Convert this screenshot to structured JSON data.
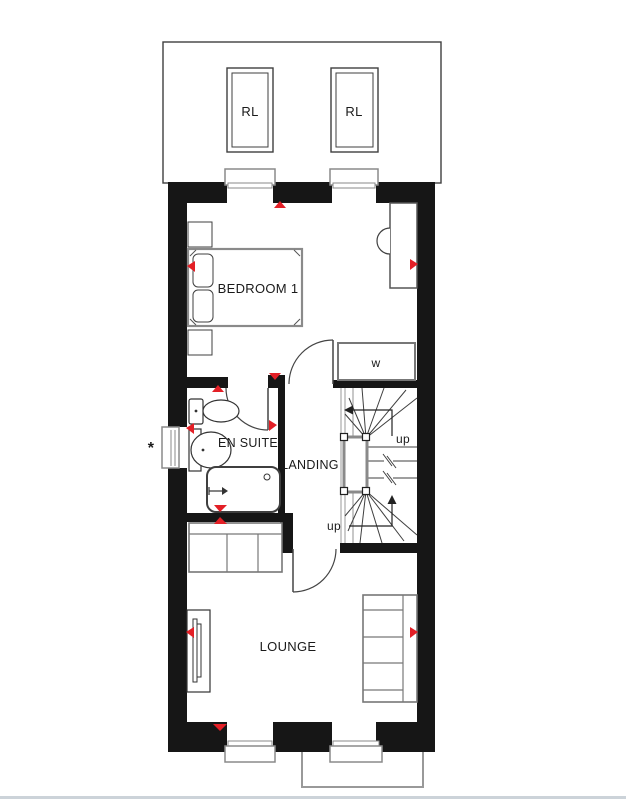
{
  "plan": {
    "rooms": {
      "bedroom": "BEDROOM 1",
      "ensuite": "EN SUITE",
      "landing": "LANDING",
      "lounge": "LOUNGE"
    },
    "labels": {
      "rooflight_1": "RL",
      "rooflight_2": "RL",
      "wardrobe": "w",
      "stairs_up_top": "up",
      "stairs_up_bottom": "up",
      "window_note": "*"
    },
    "colors": {
      "wall": "#161616",
      "marker": "#e31f26",
      "furniture": "#777777",
      "window_frame": "#8a8a8a",
      "line": "#3f3f3f",
      "footer_divider": "#ccd3d9"
    }
  }
}
